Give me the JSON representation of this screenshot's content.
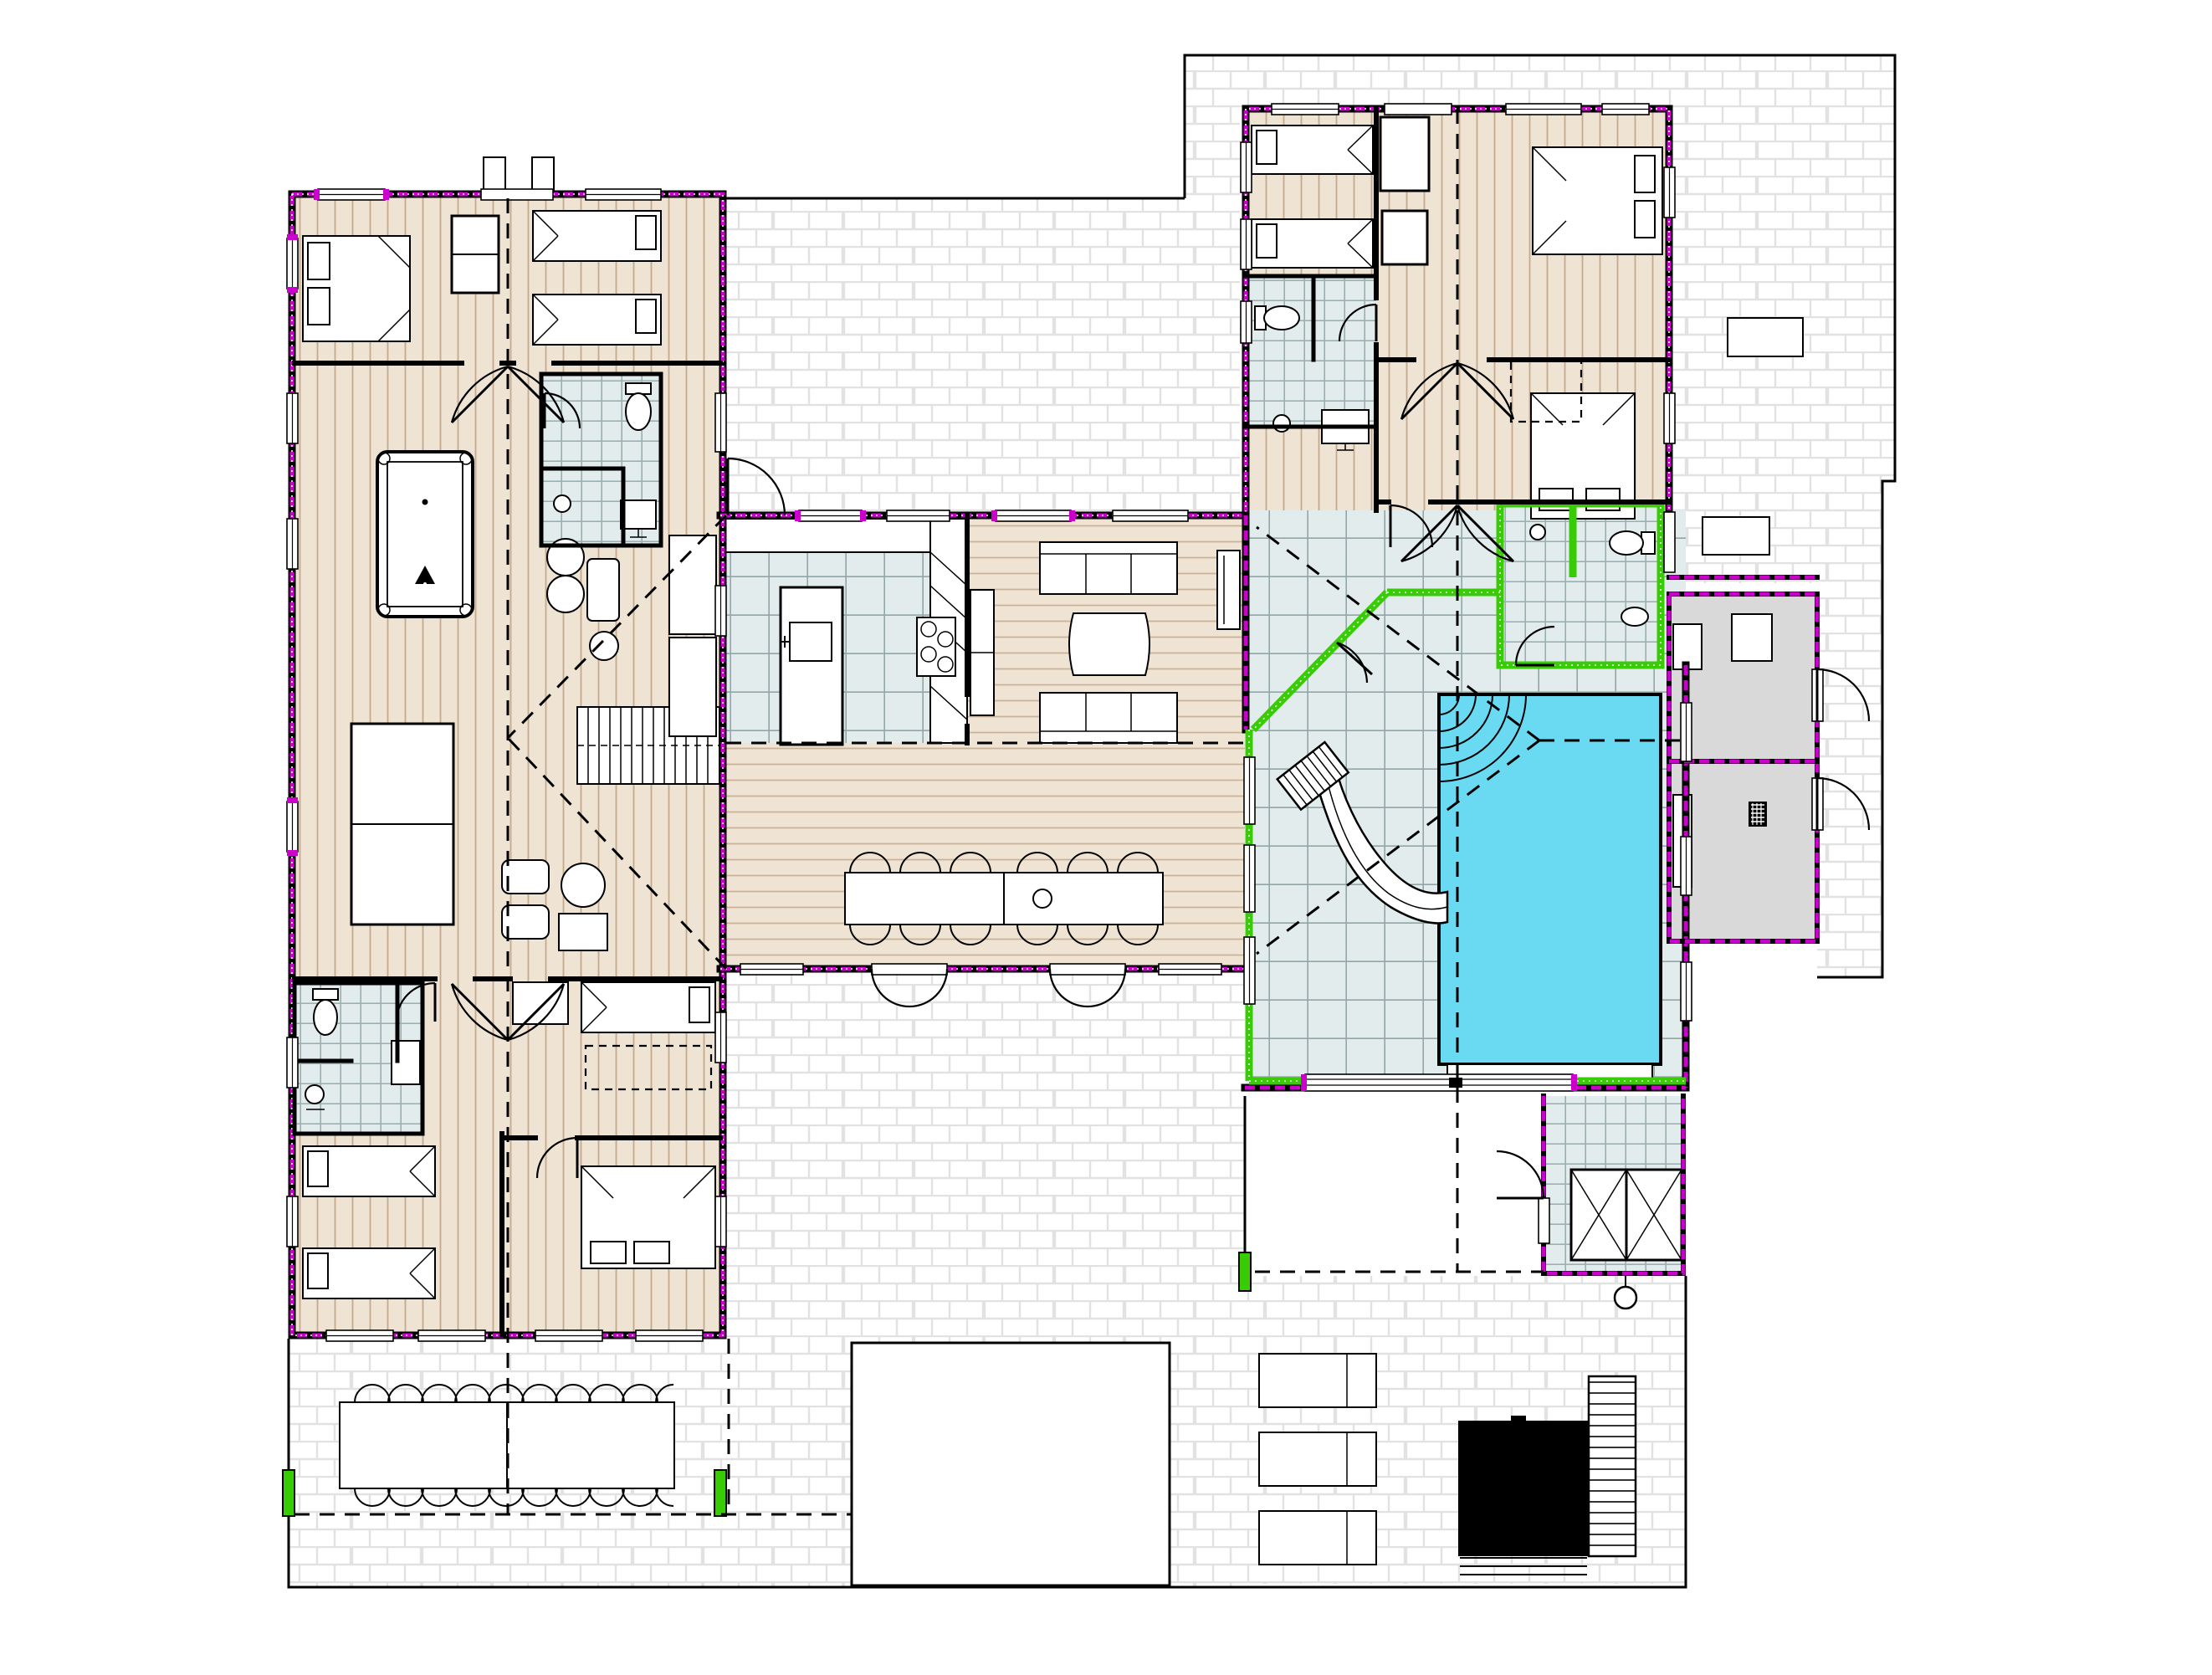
{
  "page": {
    "kind": "architectural-floor-plan",
    "view": "ground-floor-plan",
    "style": "CAD vector drawing, no text labels visible"
  },
  "colors": {
    "paper": "#ffffff",
    "wall": "#000000",
    "exterior_wall_accent": "#cc00cc",
    "glass_pool_wall": "#38cc05",
    "pool_water": "#6ad9f2",
    "wood_floor": "#efe4d3",
    "wood_floor_stripe": "#c3a98d",
    "deck_plank_line": "#c9b29a",
    "tile_floor": "#e2ecec",
    "tile_line": "#8fa7a7",
    "terrace_tile": "#ffffff",
    "terrace_tile_line": "#e2e2e2",
    "technical_room_floor": "#d9d9d9",
    "roof_line": "#000000"
  },
  "areas": {
    "left_wing": {
      "floor": "wood plank (vertical)",
      "rooms": [
        {
          "name": "bedroom-double-nw",
          "furniture": [
            "double-bed",
            "wardrobe"
          ]
        },
        {
          "name": "bedroom-twin-ne",
          "furniture": [
            "single-bed",
            "single-bed"
          ]
        },
        {
          "name": "bathroom-upper",
          "fixtures": [
            "toilet",
            "washbasin",
            "shower"
          ]
        },
        {
          "name": "games-lounge",
          "furniture": [
            "billiard-table",
            "long-table",
            "chairs",
            "armchair",
            "floor-lamps",
            "staircase",
            "wardrobe-column"
          ]
        },
        {
          "name": "bathroom-lower",
          "fixtures": [
            "toilet",
            "washbasin",
            "shower"
          ]
        },
        {
          "name": "bedroom-twin-sw",
          "furniture": [
            "single-bed",
            "single-bed"
          ]
        },
        {
          "name": "bedroom-s",
          "furniture": [
            "single-bed",
            "trundle-bed",
            "desk"
          ]
        },
        {
          "name": "bedroom-double-se",
          "furniture": [
            "double-bed"
          ]
        }
      ]
    },
    "central_wing": {
      "rooms": [
        {
          "name": "kitchen",
          "floor": "tile",
          "furniture": [
            "island-with-sink",
            "cooktop-4-burner",
            "counter-run",
            "tall-cabinets"
          ]
        },
        {
          "name": "lounge",
          "floor": "wood deck",
          "furniture": [
            "sofa",
            "sofa",
            "coffee-table",
            "tv-bench",
            "shelf"
          ]
        },
        {
          "name": "dining-room",
          "floor": "wood deck",
          "furniture": [
            "dining-table"
          ],
          "dining_seats": 12
        }
      ]
    },
    "right_wing": {
      "floor": "wood plank (vertical)",
      "rooms": [
        {
          "name": "bedroom-twin-nw",
          "furniture": [
            "single-bed",
            "single-bed"
          ]
        },
        {
          "name": "bedroom-double-ne",
          "furniture": [
            "double-bed"
          ]
        },
        {
          "name": "bathroom",
          "fixtures": [
            "toilet",
            "washbasin",
            "shower"
          ]
        },
        {
          "name": "bedroom-double-e",
          "furniture": [
            "double-bed"
          ],
          "features": [
            "roof-skylight-dashed"
          ]
        },
        {
          "name": "pool-hall",
          "floor": "tile",
          "features": [
            "indoor-pool",
            "water-slide",
            "corner-steps",
            "glass-walls-green"
          ]
        },
        {
          "name": "pool-wc",
          "fixtures": [
            "toilet",
            "washbasin",
            "basin"
          ]
        },
        {
          "name": "storage-room-upper",
          "floor": "technical-gray",
          "furniture": [
            "workbench",
            "cabinet"
          ]
        },
        {
          "name": "storage-room-lower",
          "floor": "technical-gray",
          "furniture": [
            "shelf",
            "floor-drain"
          ]
        },
        {
          "name": "changing-room",
          "fixtures": [
            "wardrobe-x2",
            "outdoor-shower"
          ]
        }
      ]
    },
    "outdoor": {
      "north_boundary_terrace": {
        "floor": "white tile",
        "furniture": [
          "table"
        ]
      },
      "courtyard_terrace": {
        "floor": "white tile"
      },
      "east_patio": {
        "floor": "white tile",
        "furniture": [
          "table"
        ]
      },
      "south_terrace": {
        "floor": "white tile",
        "furniture": [
          "outdoor-dining-table"
        ],
        "dining_seats": 20,
        "features": [
          "lawn-recess",
          "gate-markers-green"
        ]
      },
      "pool_terrace": {
        "floor": "white tile",
        "furniture": [
          "sun-lounger",
          "sun-lounger",
          "sun-lounger"
        ],
        "features": [
          "plunge-pool",
          "wood-deck",
          "steps",
          "outdoor-shower"
        ]
      }
    }
  },
  "counts": {
    "bedrooms": 7,
    "bathrooms": 4,
    "indoor_pools": 1,
    "outdoor_plunge_pools": 1,
    "water_slides": 1,
    "billiard_tables": 1,
    "sun_loungers": 3,
    "indoor_dining_seats": 12,
    "outdoor_dining_seats": 20
  }
}
